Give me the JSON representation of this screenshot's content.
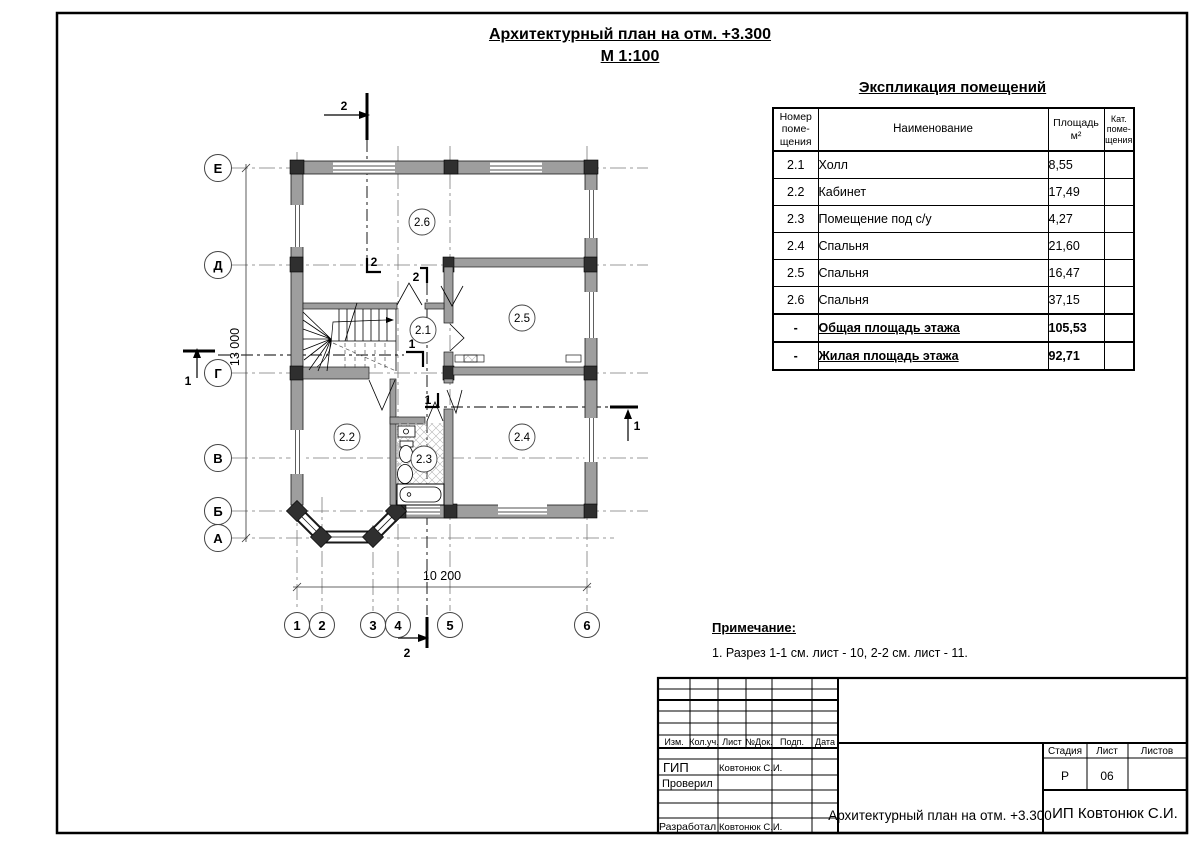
{
  "title": {
    "line1": "Архитектурный план на отм. +3.300",
    "line2": "М 1:100"
  },
  "explication": {
    "title": "Экспликация помещений",
    "headers": {
      "num": "Номер\nпоме-\nщения",
      "name": "Наименование",
      "area": "Площадь\nм²",
      "cat": "Кат.\nпоме-\nщения"
    },
    "rows": [
      {
        "num": "2.1",
        "name": "Холл",
        "area": "8,55",
        "cat": ""
      },
      {
        "num": "2.2",
        "name": "Кабинет",
        "area": "17,49",
        "cat": ""
      },
      {
        "num": "2.3",
        "name": "Помещение под с/у",
        "area": "4,27",
        "cat": ""
      },
      {
        "num": "2.4",
        "name": "Спальня",
        "area": "21,60",
        "cat": ""
      },
      {
        "num": "2.5",
        "name": "Спальня",
        "area": "16,47",
        "cat": ""
      },
      {
        "num": "2.6",
        "name": "Спальня",
        "area": "37,15",
        "cat": ""
      },
      {
        "num": "-",
        "name": "Общая площадь этажа",
        "area": "105,53",
        "cat": ""
      },
      {
        "num": "-",
        "name": "Жилая площадь этажа",
        "area": "92,71",
        "cat": ""
      }
    ]
  },
  "notes": {
    "title": "Примечание:",
    "item1": "1. Разрез 1-1 см. лист - 10, 2-2 см. лист - 11."
  },
  "plan": {
    "axes_left": [
      "Е",
      "Д",
      "Г",
      "В",
      "Б",
      "А"
    ],
    "axes_bottom": [
      "1",
      "2",
      "3",
      "4",
      "5",
      "6"
    ],
    "rooms": [
      "2.1",
      "2.2",
      "2.3",
      "2.4",
      "2.5",
      "2.6"
    ],
    "dim_width": "10 200",
    "dim_height": "13 000",
    "section1": "1",
    "section2": "2"
  },
  "stamp": {
    "header_cols": [
      "Изм.",
      "Кол.уч.",
      "Лист",
      "№Док.",
      "Подп.",
      "Дата"
    ],
    "roles": [
      {
        "label": "ГИП",
        "name": "Ковтонюк С.И."
      },
      {
        "label": "Проверил",
        "name": ""
      },
      {
        "label": "Разработал",
        "name": "Ковтонюк С.И."
      }
    ],
    "stage_label": "Стадия",
    "sheet_label": "Лист",
    "sheets_label": "Листов",
    "stage": "Р",
    "sheet": "06",
    "sheets": "",
    "doc_title": "Архитектурный план на отм. +3.300",
    "org": "ИП Ковтонюк С.И."
  },
  "colors": {
    "wall": "#9e9e9e",
    "column": "#2f2f2f",
    "line": "#000000",
    "axis": "#7a7a7a"
  }
}
